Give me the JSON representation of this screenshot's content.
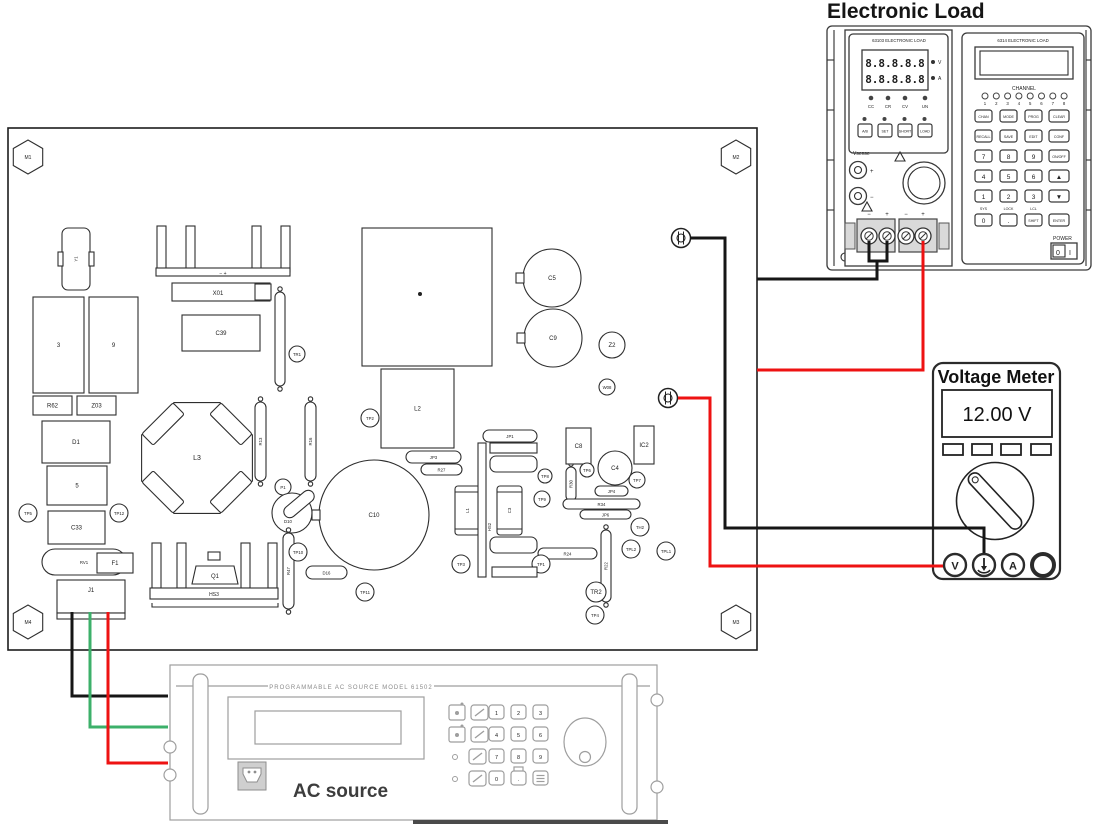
{
  "titles": {
    "electronic_load": "Electronic Load"
  },
  "colors": {
    "black": "#161616",
    "red": "#ee1212",
    "green": "#3cb06a",
    "line": "#2e2e2e"
  },
  "pcb": {
    "mount_holes": [
      {
        "label": "M1",
        "cx": 28,
        "cy": 157
      },
      {
        "label": "M2",
        "cx": 736,
        "cy": 157
      },
      {
        "label": "M3",
        "cx": 736,
        "cy": 622
      },
      {
        "label": "M4",
        "cx": 28,
        "cy": 622
      }
    ],
    "terminals": [
      {
        "cx": 681,
        "cy": 238
      },
      {
        "cx": 668,
        "cy": 398
      }
    ],
    "hs1_label": "X01",
    "hs1_marks": "−      +",
    "hs3_label": "HS3",
    "q1_label": "Q1",
    "hs2_label": "HS2",
    "components": [
      {
        "t": "vcap",
        "x": 62,
        "y": 228,
        "w": 28,
        "h": 62,
        "label": "Y1"
      },
      {
        "t": "rect",
        "x": 33,
        "y": 297,
        "w": 51,
        "h": 96,
        "label": "3"
      },
      {
        "t": "rect",
        "x": 89,
        "y": 297,
        "w": 49,
        "h": 96,
        "label": "9"
      },
      {
        "t": "rect",
        "x": 33,
        "y": 396,
        "w": 39,
        "h": 19,
        "label": "R62"
      },
      {
        "t": "rect",
        "x": 77,
        "y": 396,
        "w": 39,
        "h": 19,
        "label": "Z03"
      },
      {
        "t": "rect",
        "x": 42,
        "y": 421,
        "w": 68,
        "h": 42,
        "label": "D1"
      },
      {
        "t": "rect",
        "x": 47,
        "y": 466,
        "w": 60,
        "h": 39,
        "label": "5"
      },
      {
        "t": "rect",
        "x": 48,
        "y": 511,
        "w": 57,
        "h": 33,
        "label": "C33"
      },
      {
        "t": "circle",
        "cx": 28,
        "cy": 513,
        "r": 9,
        "label": "TP5"
      },
      {
        "t": "circle",
        "cx": 119,
        "cy": 513,
        "r": 9,
        "label": "TP12"
      },
      {
        "t": "pill",
        "x": 42,
        "y": 549,
        "w": 84,
        "h": 26,
        "label": "RV1"
      },
      {
        "t": "rect",
        "x": 97,
        "y": 553,
        "w": 36,
        "h": 20,
        "label": "F1"
      },
      {
        "t": "conn",
        "x": 57,
        "y": 580,
        "w": 68,
        "h": 37,
        "label": "J1"
      },
      {
        "t": "rect",
        "x": 182,
        "y": 315,
        "w": 78,
        "h": 36,
        "label": "C39"
      },
      {
        "t": "pillv",
        "x": 275,
        "y": 292,
        "w": 10,
        "h": 94,
        "label": ""
      },
      {
        "t": "circle",
        "cx": 297,
        "cy": 354,
        "r": 8,
        "label": "TR1"
      },
      {
        "t": "rect",
        "x": 362,
        "y": 228,
        "w": 130,
        "h": 138,
        "label": "",
        "dot": true
      },
      {
        "t": "rect",
        "x": 381,
        "y": 369,
        "w": 73,
        "h": 79,
        "label": "L2"
      },
      {
        "t": "cap",
        "cx": 552,
        "cy": 278,
        "r": 29,
        "label": "C5"
      },
      {
        "t": "cap",
        "cx": 553,
        "cy": 338,
        "r": 29,
        "label": "C9"
      },
      {
        "t": "circle",
        "cx": 612,
        "cy": 345,
        "r": 13,
        "label": "Z2"
      },
      {
        "t": "circle",
        "cx": 607,
        "cy": 387,
        "r": 8,
        "label": "W08"
      },
      {
        "t": "octo",
        "cx": 197,
        "cy": 458,
        "r": 60,
        "label": "L3"
      },
      {
        "t": "pillv",
        "x": 255,
        "y": 402,
        "w": 11,
        "h": 79,
        "label": "R13"
      },
      {
        "t": "pillv",
        "x": 305,
        "y": 402,
        "w": 11,
        "h": 79,
        "label": "R16"
      },
      {
        "t": "circle",
        "cx": 370,
        "cy": 418,
        "r": 9,
        "label": "TP2"
      },
      {
        "t": "circle",
        "cx": 283,
        "cy": 487,
        "r": 8,
        "label": "P1"
      },
      {
        "t": "dcirc",
        "cx": 292,
        "cy": 513,
        "r": 20,
        "label": "D10"
      },
      {
        "t": "cap",
        "cx": 374,
        "cy": 515,
        "r": 55,
        "label": "C10"
      },
      {
        "t": "pillv",
        "x": 283,
        "y": 533,
        "w": 11,
        "h": 76,
        "label": "R47"
      },
      {
        "t": "circle",
        "cx": 298,
        "cy": 552,
        "r": 9,
        "label": "TP10"
      },
      {
        "t": "pill",
        "x": 306,
        "y": 566,
        "w": 41,
        "h": 13,
        "label": "D16"
      },
      {
        "t": "pill",
        "x": 406,
        "y": 451,
        "w": 55,
        "h": 12,
        "label": "JP3"
      },
      {
        "t": "pill",
        "x": 421,
        "y": 464,
        "w": 41,
        "h": 11,
        "label": "R27"
      },
      {
        "t": "cyl",
        "x": 455,
        "y": 486,
        "w": 25,
        "h": 49,
        "label": "L1"
      },
      {
        "t": "cyl",
        "x": 497,
        "y": 486,
        "w": 25,
        "h": 49,
        "label": "C3"
      },
      {
        "t": "pill",
        "x": 483,
        "y": 430,
        "w": 54,
        "h": 12,
        "label": "JP1"
      },
      {
        "t": "pillv",
        "x": 566,
        "y": 467,
        "w": 10,
        "h": 34,
        "label": "R30"
      },
      {
        "t": "rect",
        "x": 566,
        "y": 428,
        "w": 25,
        "h": 36,
        "label": "C8"
      },
      {
        "t": "circle",
        "cx": 615,
        "cy": 468,
        "r": 17,
        "label": "C4"
      },
      {
        "t": "circle",
        "cx": 637,
        "cy": 480,
        "r": 8,
        "label": "TP7"
      },
      {
        "t": "circle",
        "cx": 587,
        "cy": 470,
        "r": 7,
        "label": "TP6"
      },
      {
        "t": "rect",
        "x": 634,
        "y": 426,
        "w": 20,
        "h": 38,
        "label": "IC2"
      },
      {
        "t": "pill",
        "x": 595,
        "y": 486,
        "w": 33,
        "h": 10,
        "label": "JP4"
      },
      {
        "t": "pill",
        "x": 563,
        "y": 499,
        "w": 77,
        "h": 10,
        "label": "R34"
      },
      {
        "t": "pill",
        "x": 580,
        "y": 510,
        "w": 51,
        "h": 9,
        "label": "JP6"
      },
      {
        "t": "pillv",
        "x": 601,
        "y": 530,
        "w": 10,
        "h": 72,
        "label": "R22"
      },
      {
        "t": "pill",
        "x": 538,
        "y": 548,
        "w": 59,
        "h": 11,
        "label": "R24"
      },
      {
        "t": "circle",
        "cx": 545,
        "cy": 476,
        "r": 7,
        "label": "TP8"
      },
      {
        "t": "circle",
        "cx": 542,
        "cy": 499,
        "r": 8,
        "label": "TP9"
      },
      {
        "t": "circle",
        "cx": 461,
        "cy": 564,
        "r": 9,
        "label": "TP3"
      },
      {
        "t": "circle",
        "cx": 541,
        "cy": 564,
        "r": 9,
        "label": "TP1"
      },
      {
        "t": "circle",
        "cx": 640,
        "cy": 527,
        "r": 9,
        "label": "TH2"
      },
      {
        "t": "circle",
        "cx": 631,
        "cy": 549,
        "r": 9,
        "label": "TPL2"
      },
      {
        "t": "circle",
        "cx": 666,
        "cy": 551,
        "r": 9,
        "label": "TPL1"
      },
      {
        "t": "circle",
        "cx": 596,
        "cy": 592,
        "r": 10,
        "label": "TR2"
      },
      {
        "t": "circle",
        "cx": 595,
        "cy": 615,
        "r": 9,
        "label": "TP4"
      },
      {
        "t": "circle",
        "cx": 365,
        "cy": 592,
        "r": 9,
        "label": "TP11"
      }
    ]
  },
  "wires": [
    {
      "name": "wire-black-pcb-to-meter-gnd",
      "color": "black",
      "points": "690,238 725,238 725,528 984,528 984,553"
    },
    {
      "name": "wire-black-pcb-to-load",
      "color": "black",
      "points": "757,279 877,279 877,261"
    },
    {
      "name": "wire-black-load-jumper",
      "color": "black",
      "points": "869,241 869,261 887,261 887,241"
    },
    {
      "name": "wire-red-load-to-pcb",
      "color": "red",
      "points": "923,241 923,370 757,370"
    },
    {
      "name": "wire-red-pcb-to-meter-v",
      "color": "red",
      "points": "678,398 710,398 710,566 943,566"
    },
    {
      "name": "wire-black-j1-to-ac",
      "color": "black",
      "points": "72,612 72,696 168,696"
    },
    {
      "name": "wire-green-j1-to-ac",
      "color": "green",
      "points": "90,612 90,727 168,727"
    },
    {
      "name": "wire-red-j1-to-ac",
      "color": "red",
      "points": "108,612 108,763 168,763"
    }
  ],
  "electronic_load": {
    "module": {
      "header": "63103 ELECTRONIC LOAD",
      "display_rows": [
        "8.8.8.8.8",
        "8.8.8.8.8"
      ],
      "side_labels": [
        "V",
        "A"
      ],
      "status_leds": [
        "CC",
        "CR",
        "CV",
        "UN"
      ],
      "buttons": [
        "A/B",
        "SET",
        "SHORT",
        "LOAD"
      ],
      "vsense_label": "Vsense",
      "terminal_marks": [
        "−",
        "+",
        "−",
        "+"
      ]
    },
    "mainframe": {
      "header": "6314 ELECTRONIC LOAD",
      "channel_label": "CHANNEL",
      "channels": [
        "1",
        "2",
        "3",
        "4",
        "5",
        "6",
        "7",
        "8"
      ],
      "keys": [
        [
          "CHAN",
          "MODE",
          "PROG",
          "CLEAR"
        ],
        [
          "RECALL",
          "SAVE",
          "EDIT",
          "CONF"
        ],
        [
          "7",
          "8",
          "9",
          "ON/OFF"
        ],
        [
          "4",
          "5",
          "6",
          "▲"
        ],
        [
          "1",
          "2",
          "3",
          "▼"
        ],
        [
          "0",
          ".",
          "SHIFT",
          "ENTER"
        ]
      ],
      "key_sublabels": [
        "SYS",
        "LOCK",
        "LCL"
      ],
      "power_label": "POWER",
      "power_off": "0",
      "power_on": "I"
    }
  },
  "voltage_meter": {
    "title": "Voltage Meter",
    "reading": "12.00 V",
    "buttons": [
      "",
      "",
      "",
      ""
    ],
    "terminals": [
      "V",
      "gnd",
      "A",
      ""
    ]
  },
  "ac_source": {
    "header": "PROGRAMMABLE  AC  SOURCE   MODEL   61502",
    "label": "AC source",
    "digits": [
      [
        "1",
        "2",
        "3"
      ],
      [
        "4",
        "5",
        "6"
      ],
      [
        "7",
        "8",
        "9"
      ],
      [
        "0",
        ".",
        "enter"
      ]
    ]
  }
}
